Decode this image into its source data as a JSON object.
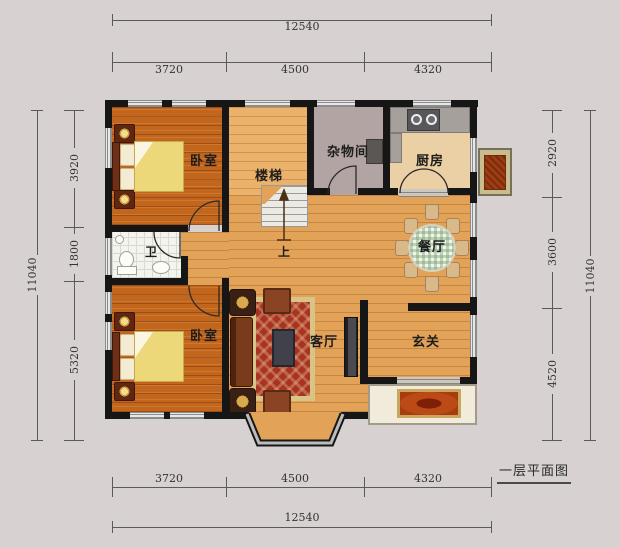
{
  "title": "一层平面图",
  "dims": {
    "top": {
      "total": "12540",
      "segs": [
        "3720",
        "4500",
        "4320"
      ]
    },
    "bottom": {
      "total": "12540",
      "segs": [
        "3720",
        "4500",
        "4320"
      ]
    },
    "left": {
      "total": "11040",
      "segs": [
        "3920",
        "1800",
        "5320"
      ]
    },
    "right": {
      "total": "11040",
      "segs": [
        "2920",
        "3600",
        "4520"
      ]
    }
  },
  "rooms": {
    "bedroom_top": "卧室",
    "bedroom_bottom": "卧室",
    "stairs": "楼梯",
    "stairs_up": "上",
    "storage": "杂物间",
    "kitchen": "厨房",
    "bath": "卫",
    "dining": "餐厅",
    "living": "客厅",
    "entry": "玄关"
  },
  "colors": {
    "background": "#d7d2d1",
    "wall": "#161616",
    "bedroom_floor": "#c2661d",
    "hall_floor": "#e2a258",
    "kitchen_floor": "#ead0a4",
    "storage_floor": "#b2a4a2",
    "bath_floor": "#f4f4ee",
    "rug": "#a93323",
    "quilt": "#ecd878",
    "dimension_text": "#333333"
  }
}
